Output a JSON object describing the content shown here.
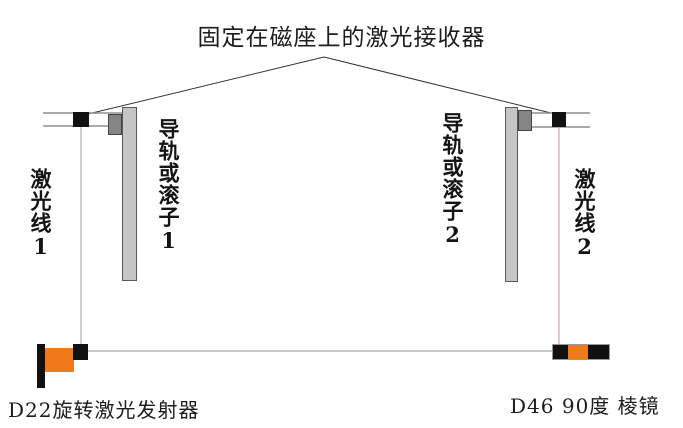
{
  "diagram": {
    "title": "固定在磁座上的激光接收器",
    "labels": {
      "laser_line_1": "激光线1",
      "rail_1": "导轨或滚子1",
      "rail_2": "导轨或滚子2",
      "laser_line_2": "激光线2",
      "transmitter": "D22旋转激光发射器",
      "prism": "D46 90度 棱镜"
    },
    "colors": {
      "orange": "#ee7a1a",
      "light_gray": "#c5c5c5",
      "dark_gray": "#858585",
      "black": "#111111",
      "rail_line": "#8f8f8f",
      "pointer_line": "#333333",
      "laser_left": "#a5a096",
      "laser_right": "#c490a0"
    }
  }
}
